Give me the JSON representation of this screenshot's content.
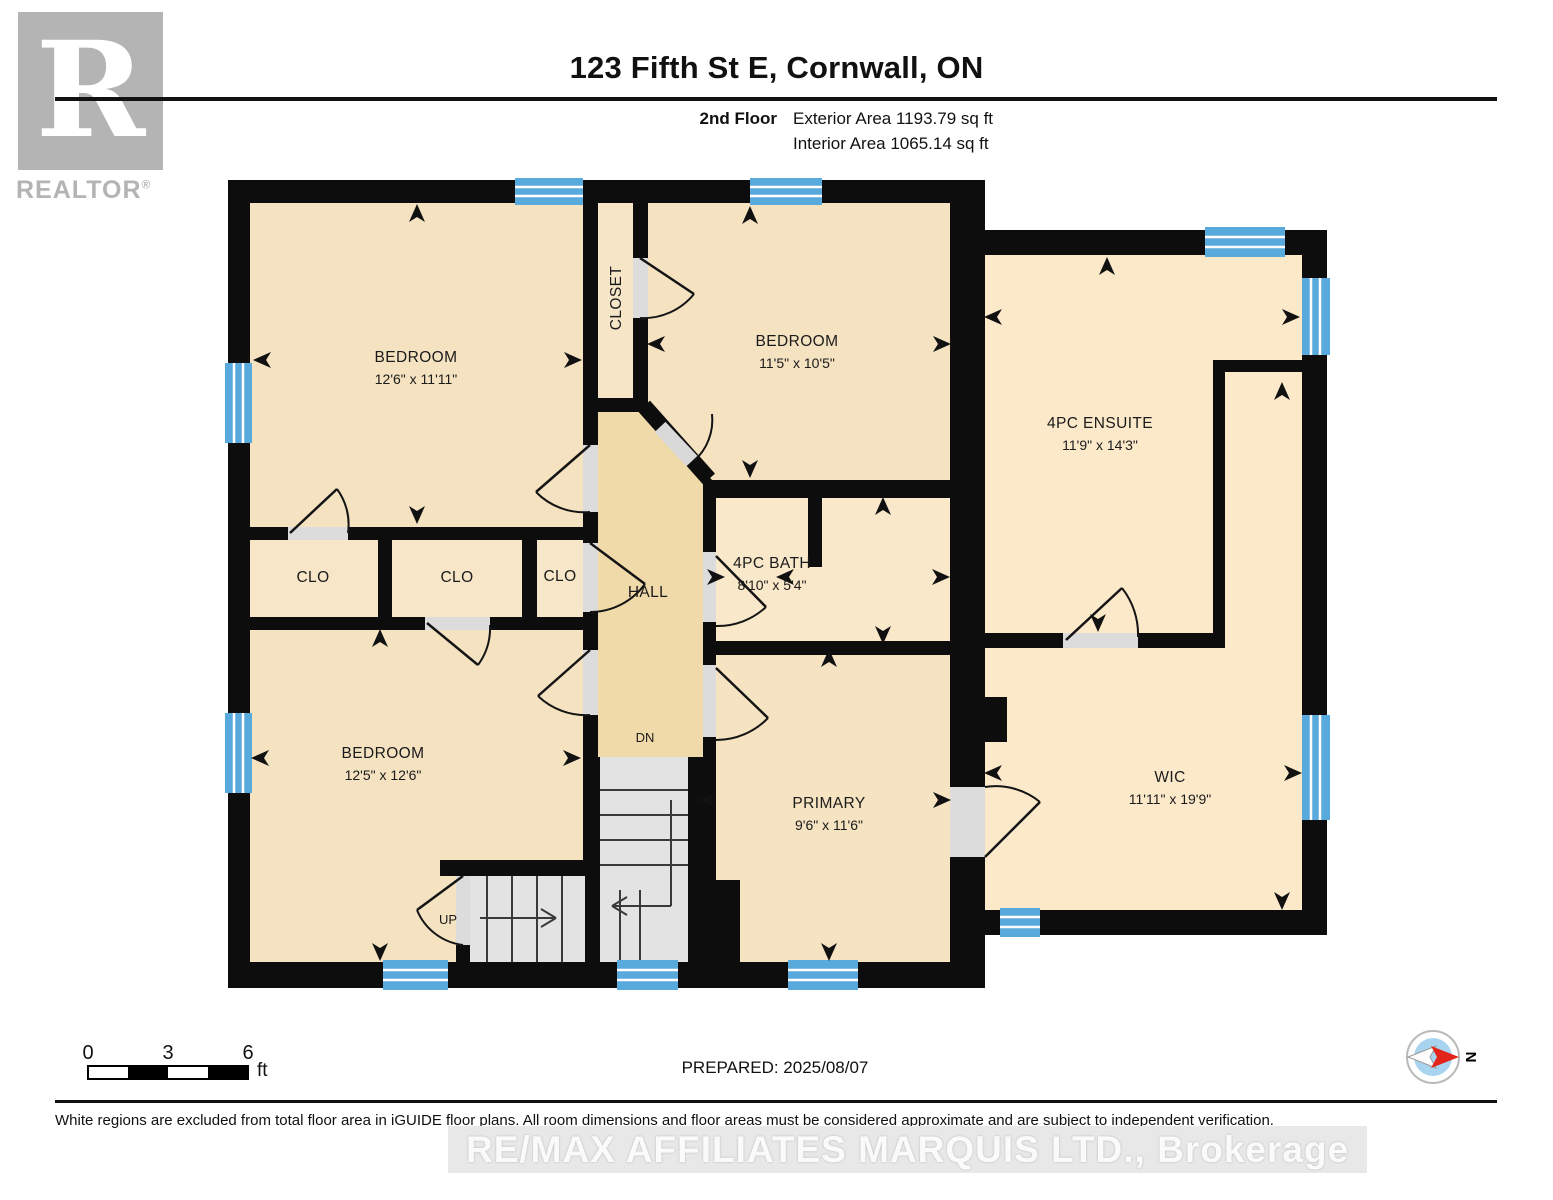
{
  "header": {
    "title": "123 Fifth St E, Cornwall, ON",
    "floor_label": "2nd Floor",
    "exterior_area": "Exterior Area 1193.79 sq ft",
    "interior_area": "Interior Area 1065.14 sq ft"
  },
  "logo": {
    "letter": "R",
    "brand": "REALTOR",
    "registered": "®"
  },
  "rooms": {
    "bedroom_top_left": {
      "name": "BEDROOM",
      "dims": "12'6\" x 11'11\""
    },
    "closet_top": {
      "name": "CLOSET"
    },
    "bedroom_top_middle": {
      "name": "BEDROOM",
      "dims": "11'5\" x 10'5\""
    },
    "ensuite": {
      "name": "4PC ENSUITE",
      "dims": "11'9\" x 14'3\""
    },
    "clo_left": {
      "name": "CLO"
    },
    "clo_middle": {
      "name": "CLO"
    },
    "clo_right": {
      "name": "CLO"
    },
    "hall": {
      "name": "HALL"
    },
    "bath": {
      "name": "4PC BATH",
      "dims": "8'10\" x 5'4\""
    },
    "bedroom_bottom_left": {
      "name": "BEDROOM",
      "dims": "12'5\" x 12'6\""
    },
    "primary": {
      "name": "PRIMARY",
      "dims": "9'6\" x 11'6\""
    },
    "wic": {
      "name": "WIC",
      "dims": "11'11\" x 19'9\""
    }
  },
  "stairs": {
    "up": "UP",
    "down": "DN"
  },
  "scale_bar": {
    "tick_0": "0",
    "tick_3": "3",
    "tick_6": "6",
    "unit": "ft"
  },
  "compass": {
    "north_label": "N"
  },
  "footer": {
    "prepared": "PREPARED: 2025/08/07",
    "disclaimer": "White regions are excluded from total floor area in iGUIDE floor plans. All room dimensions and floor areas must be considered approximate and are subject to independent verification.",
    "watermark": "RE/MAX AFFILIATES MARQUIS LTD., Brokerage"
  },
  "colors": {
    "wall": "#0d0d0d",
    "window_blue": "#58a9dc",
    "room_beige": "#f4e2c1",
    "wing_beige": "#fbe9ca",
    "hall_tan": "#f0daa9",
    "stairs_gray": "#e3e3e3",
    "logo_gray": "#b5b4b4"
  }
}
